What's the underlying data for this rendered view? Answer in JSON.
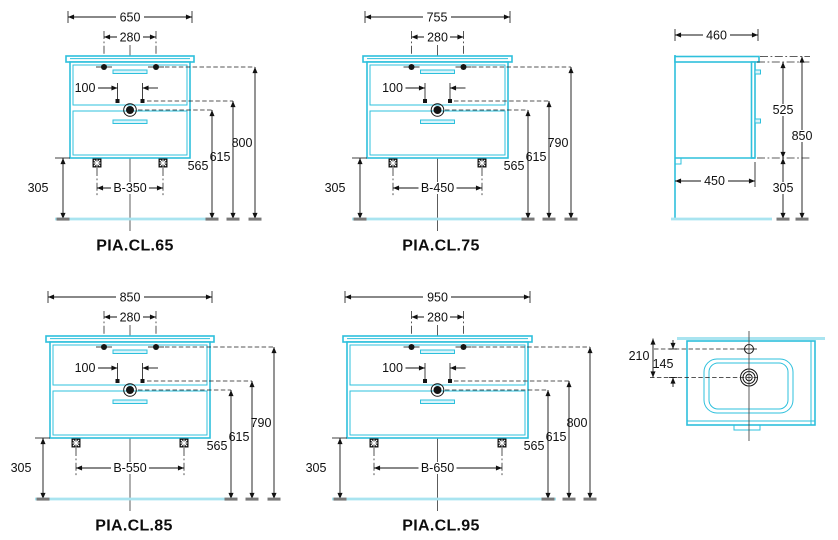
{
  "drawing": {
    "front_views": [
      {
        "label": "PIA.CL.65",
        "width": "650",
        "faucet_spacing": "280",
        "fix_spacing": "100",
        "h_top": "800",
        "h_mid": "615",
        "h_drain": "565",
        "h_floor": "305",
        "feet": "B-350"
      },
      {
        "label": "PIA.CL.75",
        "width": "755",
        "faucet_spacing": "280",
        "fix_spacing": "100",
        "h_top": "790",
        "h_mid": "615",
        "h_drain": "565",
        "h_floor": "305",
        "feet": "B-450"
      },
      {
        "label": "PIA.CL.85",
        "width": "850",
        "faucet_spacing": "280",
        "fix_spacing": "100",
        "h_top": "790",
        "h_mid": "615",
        "h_drain": "565",
        "h_floor": "305",
        "feet": "B-550"
      },
      {
        "label": "PIA.CL.95",
        "width": "950",
        "faucet_spacing": "280",
        "fix_spacing": "100",
        "h_top": "800",
        "h_mid": "615",
        "h_drain": "565",
        "h_floor": "305",
        "feet": "B-650"
      }
    ],
    "side_view": {
      "depth_top": "460",
      "depth_bottom": "450",
      "body_height": "525",
      "total_height": "850",
      "floor_clearance": "305"
    },
    "top_view": {
      "back_to_drain": "210",
      "faucet_to_drain": "145"
    },
    "colors": {
      "cabinet": "#2ec0dc",
      "floor_line": "#a9e4f0",
      "dimension_lines": "#111111"
    }
  }
}
